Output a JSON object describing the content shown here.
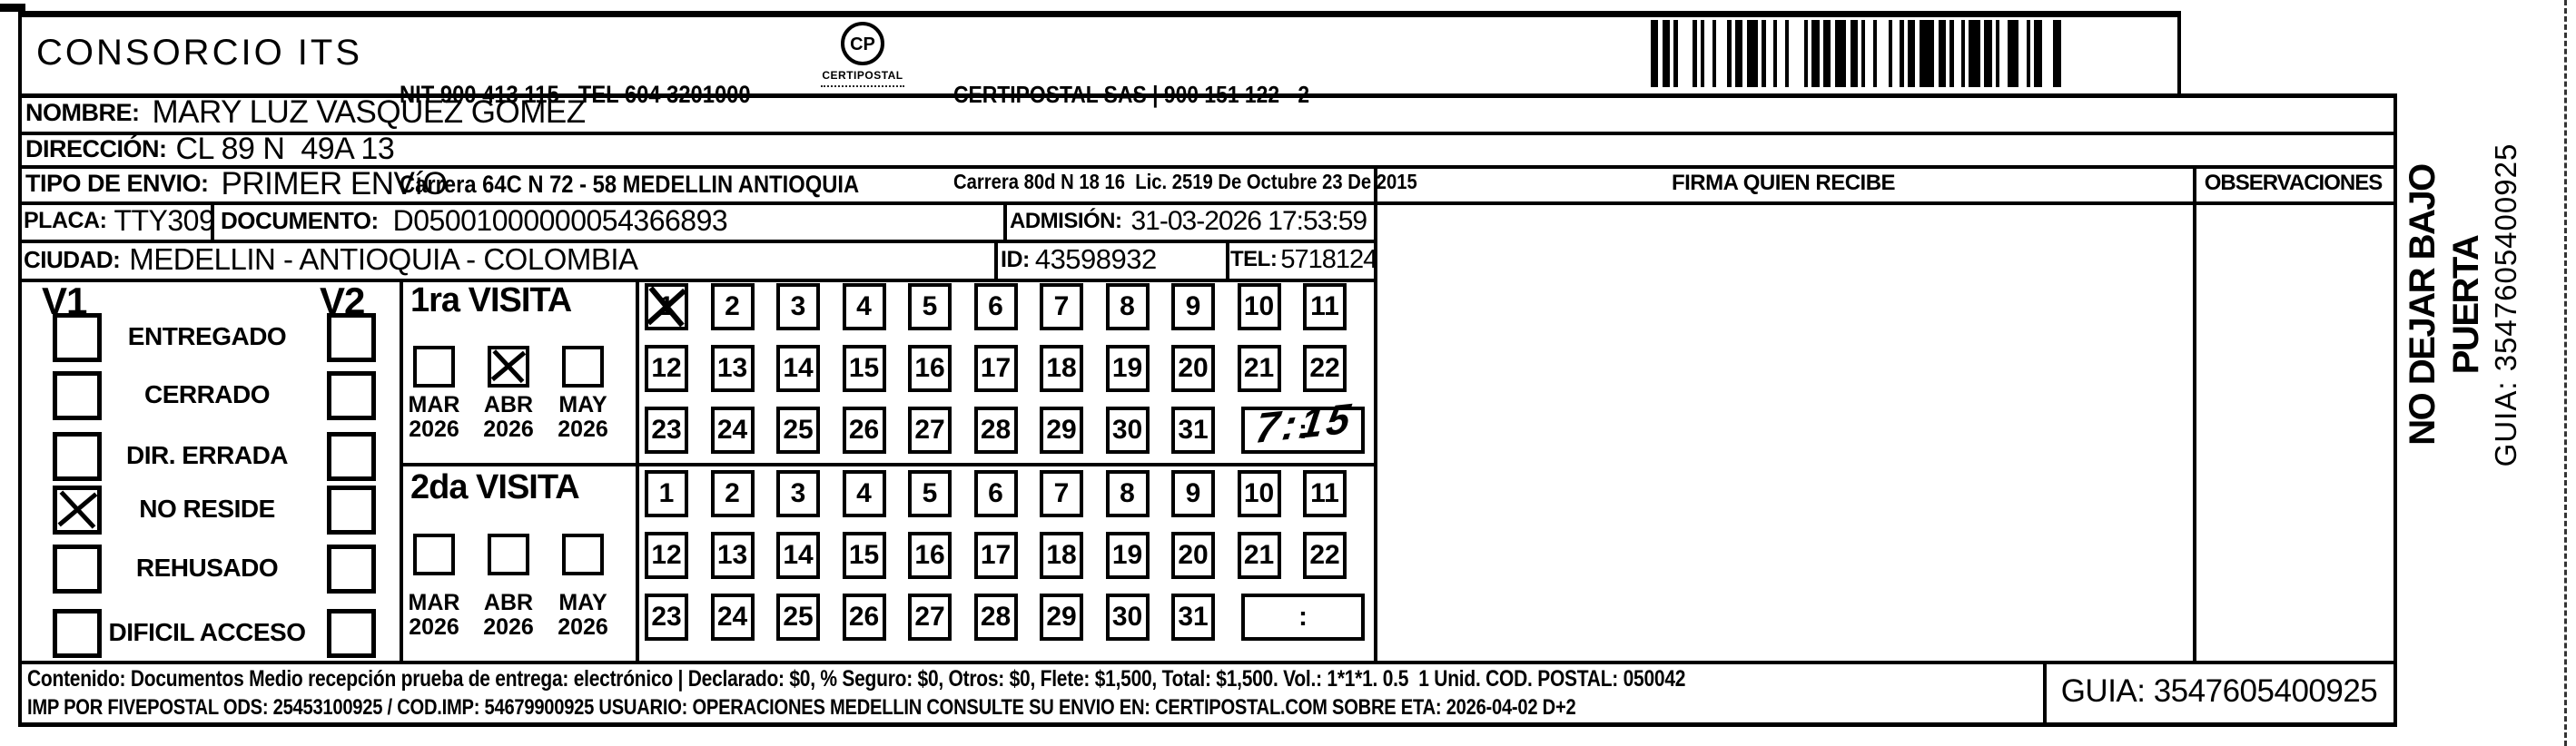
{
  "header": {
    "company": "CONSORCIO ITS",
    "nit_line1": "NIT 900 413 115 - TEL 604 3201000",
    "nit_line2": "Carrera 64C N 72 - 58 MEDELLIN ANTIOQUIA",
    "logo": {
      "monogram": "CP",
      "name": "CERTIPOSTAL"
    },
    "provider_line1": "CERTIPOSTAL SAS | 900 151 122 - 2",
    "provider_line2": "Carrera 80d N 18 16  Lic. 2519 De Octubre 23 De 2015"
  },
  "fields": {
    "nombre": {
      "label": "NOMBRE:",
      "value": "MARY LUZ VASQUEZ GOMEZ"
    },
    "direccion": {
      "label": "DIRECCIÓN:",
      "value": "CL 89 N  49A 13"
    },
    "tipo_envio": {
      "label": "TIPO DE ENVIO:",
      "value": "PRIMER ENVíO"
    },
    "placa": {
      "label": "PLACA:",
      "value": "TTY309"
    },
    "documento": {
      "label": "DOCUMENTO:",
      "value": "D05001000000054366893"
    },
    "admision": {
      "label": "ADMISIÓN:",
      "value": "31-03-2026 17:53:59"
    },
    "ciudad": {
      "label": "CIUDAD:",
      "value": "MEDELLIN - ANTIOQUIA - COLOMBIA"
    },
    "id": {
      "label": "ID:",
      "value": "43598932"
    },
    "tel": {
      "label": "TEL:",
      "value": "5718124"
    }
  },
  "columns": {
    "firma": "FIRMA QUIEN RECIBE",
    "observaciones": "OBSERVACIONES"
  },
  "status_panel": {
    "v1_header": "V1",
    "v2_header": "V2",
    "rows": [
      {
        "label": "ENTREGADO",
        "v1_checked": false,
        "v2_checked": false
      },
      {
        "label": "CERRADO",
        "v1_checked": false,
        "v2_checked": false
      },
      {
        "label": "DIR. ERRADA",
        "v1_checked": false,
        "v2_checked": false
      },
      {
        "label": "NO RESIDE",
        "v1_checked": true,
        "v2_checked": false
      },
      {
        "label": "REHUSADO",
        "v1_checked": false,
        "v2_checked": false
      },
      {
        "label": "DIFICIL ACCESO",
        "v1_checked": false,
        "v2_checked": false
      }
    ]
  },
  "visits": [
    {
      "title": "1ra VISITA",
      "months": [
        {
          "label": "MAR",
          "year": "2026",
          "checked": false
        },
        {
          "label": "ABR",
          "year": "2026",
          "checked": true
        },
        {
          "label": "MAY",
          "year": "2026",
          "checked": false
        }
      ],
      "day_rows": [
        [
          1,
          2,
          3,
          4,
          5,
          6,
          7,
          8,
          9,
          10,
          11
        ],
        [
          12,
          13,
          14,
          15,
          16,
          17,
          18,
          19,
          20,
          21,
          22
        ],
        [
          23,
          24,
          25,
          26,
          27,
          28,
          29,
          30,
          31
        ]
      ],
      "marked_day": 1,
      "time_separator": ":",
      "time_handwritten": "7:15"
    },
    {
      "title": "2da VISITA",
      "months": [
        {
          "label": "MAR",
          "year": "2026",
          "checked": false
        },
        {
          "label": "ABR",
          "year": "2026",
          "checked": false
        },
        {
          "label": "MAY",
          "year": "2026",
          "checked": false
        }
      ],
      "day_rows": [
        [
          1,
          2,
          3,
          4,
          5,
          6,
          7,
          8,
          9,
          10,
          11
        ],
        [
          12,
          13,
          14,
          15,
          16,
          17,
          18,
          19,
          20,
          21,
          22
        ],
        [
          23,
          24,
          25,
          26,
          27,
          28,
          29,
          30,
          31
        ]
      ],
      "marked_day": null,
      "time_separator": ":",
      "time_handwritten": ""
    }
  ],
  "side_note": {
    "line1": "NO DEJAR BAJO PUERTA",
    "line2": "GUIA: 3547605400925"
  },
  "footer": {
    "line1": "Contenido: Documentos Medio recepción prueba de entrega: electrónico | Declarado: $0, % Seguro: $0, Otros: $0, Flete: $1,500, Total: $1,500. Vol.: 1*1*1. 0.5  1 Unid. COD. POSTAL: 050042",
    "line2": "IMP POR FIVEPOSTAL ODS: 25453100925 / COD.IMP: 54679900925 USUARIO: OPERACIONES MEDELLIN CONSULTE SU ENVIO EN: CERTIPOSTAL.COM SOBRE ETA: 2026-04-02 D+2",
    "guia": "GUIA: 3547605400925"
  }
}
